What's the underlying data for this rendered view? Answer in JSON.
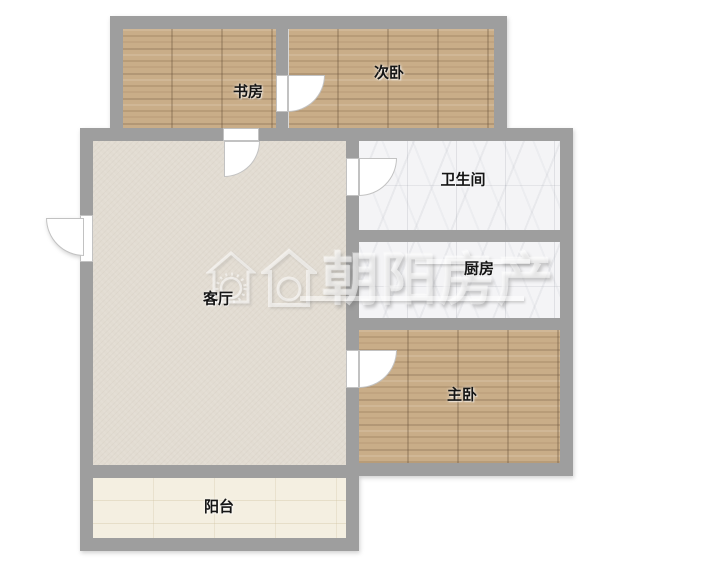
{
  "page": {
    "type": "real-estate-floor-plan",
    "background": "#ffffff"
  },
  "colors": {
    "wall": "#9e9e9e",
    "wood_floor": "#c9ad88",
    "tile_floor": "#f4f4f6",
    "living_floor": "#e2dcd2",
    "balcony_floor": "#f4efe1",
    "label_text": "#151515",
    "watermark": "#ffffff"
  },
  "rooms": [
    {
      "id": "study",
      "label": "书房",
      "floor": "wood"
    },
    {
      "id": "second-bedroom",
      "label": "次卧",
      "floor": "wood"
    },
    {
      "id": "bathroom",
      "label": "卫生间",
      "floor": "white-tile"
    },
    {
      "id": "kitchen",
      "label": "厨房",
      "floor": "white-tile"
    },
    {
      "id": "master-bedroom",
      "label": "主卧",
      "floor": "wood"
    },
    {
      "id": "living-room",
      "label": "客厅",
      "floor": "plaster"
    },
    {
      "id": "balcony",
      "label": "阳台",
      "floor": "light-tile"
    }
  ],
  "doors": [
    {
      "id": "entrance-door",
      "between": "exterior / living-room"
    },
    {
      "id": "study-door",
      "between": "study / living-room"
    },
    {
      "id": "second-bedroom-door",
      "between": "study / second-bedroom"
    },
    {
      "id": "bathroom-door",
      "between": "living-room / bathroom"
    },
    {
      "id": "master-bedroom-door",
      "between": "living-room / master-bedroom"
    }
  ],
  "watermark": {
    "text": "朝阳房产",
    "icons": [
      "house-sun-badge-icon",
      "house-outline-circle-icon"
    ]
  }
}
